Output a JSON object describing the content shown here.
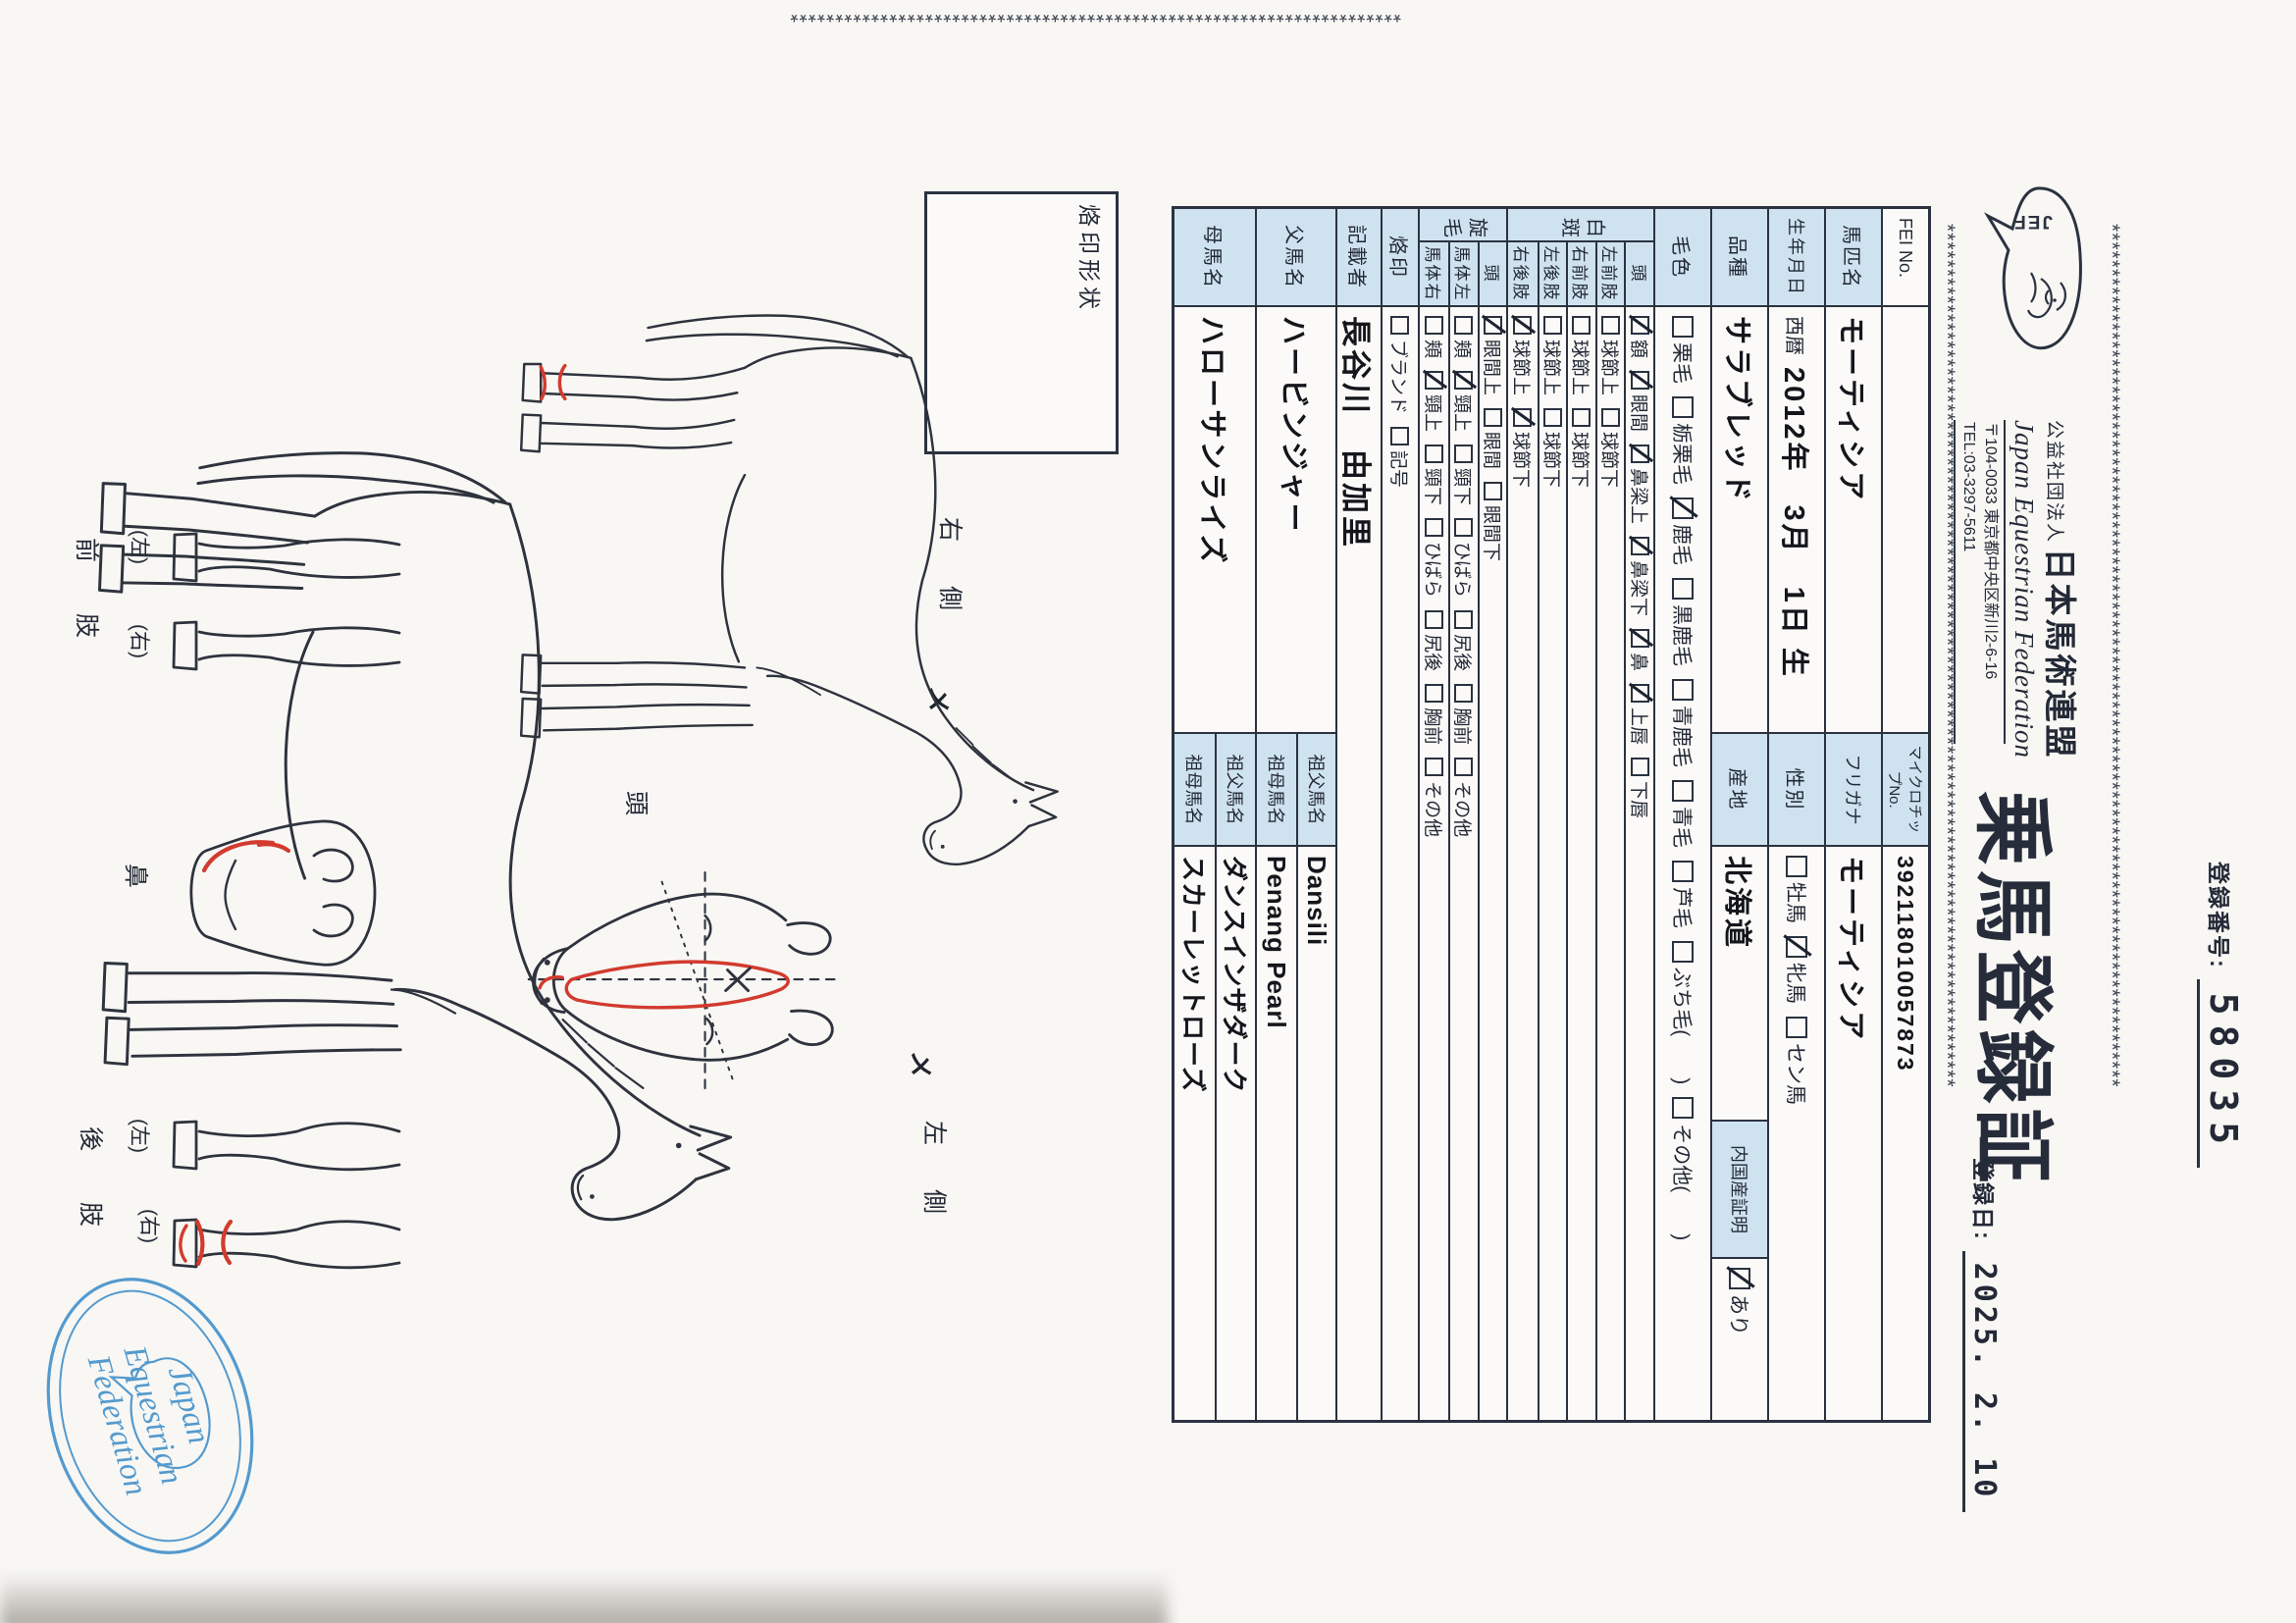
{
  "page": {
    "star_line": "************************************************************************************************",
    "star_col": "********************************************************************",
    "reg_no_label": "登録番号:",
    "reg_no": "58035",
    "reg_date_label": "登録日:",
    "reg_date": "2025. 2. 10",
    "org_small": "公益社団法人",
    "org_name": "日本馬術連盟",
    "org_en": "Japan Equestrian Federation",
    "org_addr": "〒104-0033 東京都中央区新川2-6-16",
    "org_tel": "TEL:03-3297-5611",
    "logo_text": "JEF",
    "title": "乗馬登録証"
  },
  "table": {
    "fei_label": "FEI No.",
    "fei_value": "",
    "chip_label": "マイクロチップNo.",
    "chip_value": "392118010057873",
    "name_label": "馬匹名",
    "name_value": "モーティシア",
    "kana_label": "フリガナ",
    "kana_value": "モーティシア",
    "birth_label": "生年月日",
    "birth_era": "西暦",
    "birth_value": "2012年　3月　1日 生",
    "sex_label": "性別",
    "sex_options": [
      {
        "label": "牡馬",
        "checked": false
      },
      {
        "label": "牝馬",
        "checked": true
      },
      {
        "label": "セン馬",
        "checked": false
      }
    ],
    "breed_label": "品種",
    "breed_value": "サラブレッド",
    "origin_label": "産地",
    "origin_value": "北海道",
    "domestic_label": "内国産証明",
    "domestic_options": [
      {
        "label": "あり",
        "checked": true
      }
    ],
    "color_label": "毛色",
    "color_options": [
      {
        "label": "栗毛",
        "checked": false
      },
      {
        "label": "栃栗毛",
        "checked": false
      },
      {
        "label": "鹿毛",
        "checked": true
      },
      {
        "label": "黒鹿毛",
        "checked": false
      },
      {
        "label": "青鹿毛",
        "checked": false
      },
      {
        "label": "青毛",
        "checked": false
      },
      {
        "label": "芦毛",
        "checked": false
      },
      {
        "label": "ぶち毛(　　)",
        "checked": false
      },
      {
        "label": "その他(　　)",
        "checked": false
      }
    ],
    "hakuhan_label": "白斑",
    "hakuhan_rows": [
      {
        "part": "頭",
        "options": [
          {
            "label": "額",
            "checked": true
          },
          {
            "label": "眼間",
            "checked": true
          },
          {
            "label": "鼻梁上",
            "checked": true
          },
          {
            "label": "鼻梁下",
            "checked": true
          },
          {
            "label": "鼻",
            "checked": true
          },
          {
            "label": "上唇",
            "checked": true
          },
          {
            "label": "下唇",
            "checked": false
          }
        ]
      },
      {
        "part": "左前肢",
        "options": [
          {
            "label": "球節上",
            "checked": false
          },
          {
            "label": "球節下",
            "checked": false
          }
        ]
      },
      {
        "part": "右前肢",
        "options": [
          {
            "label": "球節上",
            "checked": false
          },
          {
            "label": "球節下",
            "checked": false
          }
        ]
      },
      {
        "part": "左後肢",
        "options": [
          {
            "label": "球節上",
            "checked": false
          },
          {
            "label": "球節下",
            "checked": false
          }
        ]
      },
      {
        "part": "右後肢",
        "options": [
          {
            "label": "球節上",
            "checked": true
          },
          {
            "label": "球節下",
            "checked": true
          }
        ]
      }
    ],
    "senmou_label": "旋毛",
    "senmou_rows": [
      {
        "part": "頭",
        "options": [
          {
            "label": "眼間上",
            "checked": true
          },
          {
            "label": "眼間",
            "checked": false
          },
          {
            "label": "眼間下",
            "checked": false
          }
        ]
      },
      {
        "part": "馬体左",
        "options": [
          {
            "label": "頬",
            "checked": false
          },
          {
            "label": "頸上",
            "checked": true
          },
          {
            "label": "頸下",
            "checked": false
          },
          {
            "label": "ひばら",
            "checked": false
          },
          {
            "label": "尻後",
            "checked": false
          },
          {
            "label": "胸前",
            "checked": false
          },
          {
            "label": "その他",
            "checked": false
          }
        ]
      },
      {
        "part": "馬体右",
        "options": [
          {
            "label": "頬",
            "checked": false
          },
          {
            "label": "頸上",
            "checked": true
          },
          {
            "label": "頸下",
            "checked": false
          },
          {
            "label": "ひばら",
            "checked": false
          },
          {
            "label": "尻後",
            "checked": false
          },
          {
            "label": "胸前",
            "checked": false
          },
          {
            "label": "その他",
            "checked": false
          }
        ]
      }
    ],
    "brand_label": "烙印",
    "brand_options": [
      {
        "label": "ブランド",
        "checked": false
      },
      {
        "label": "記号",
        "checked": false
      }
    ],
    "recorder_label": "記載者",
    "recorder_value": "長谷川　由加里",
    "sire_label": "父馬名",
    "sire_value": "ハービンジャー",
    "sire_sire_label": "祖父馬名",
    "sire_sire_value": "Dansili",
    "sire_dam_label": "祖母馬名",
    "sire_dam_value": "Penang Pearl",
    "dam_label": "母馬名",
    "dam_value": "ハローサンライズ",
    "dam_sire_label": "祖父馬名",
    "dam_sire_value": "ダンスインザダーク",
    "dam_dam_label": "祖母馬名",
    "dam_dam_value": "スカーレットローズ"
  },
  "diagram": {
    "brand_box_label": "烙印形状",
    "right_side_label": "右　側",
    "left_side_label": "左　側",
    "head_label": "頭",
    "nose_label": "鼻",
    "front_leg_label": "前肢",
    "hind_leg_label": "後肢",
    "left_paren": "(左)",
    "right_paren": "(右)",
    "whorl_mark": "メ",
    "stamp_line1": "Japan",
    "stamp_line2": "Equestrian",
    "stamp_line3": "Federation",
    "colors": {
      "red": "#d23b2e",
      "stamp_blue": "#3e8ec9",
      "ink": "#2b3240",
      "label_bg": "#cfe2f0"
    }
  }
}
